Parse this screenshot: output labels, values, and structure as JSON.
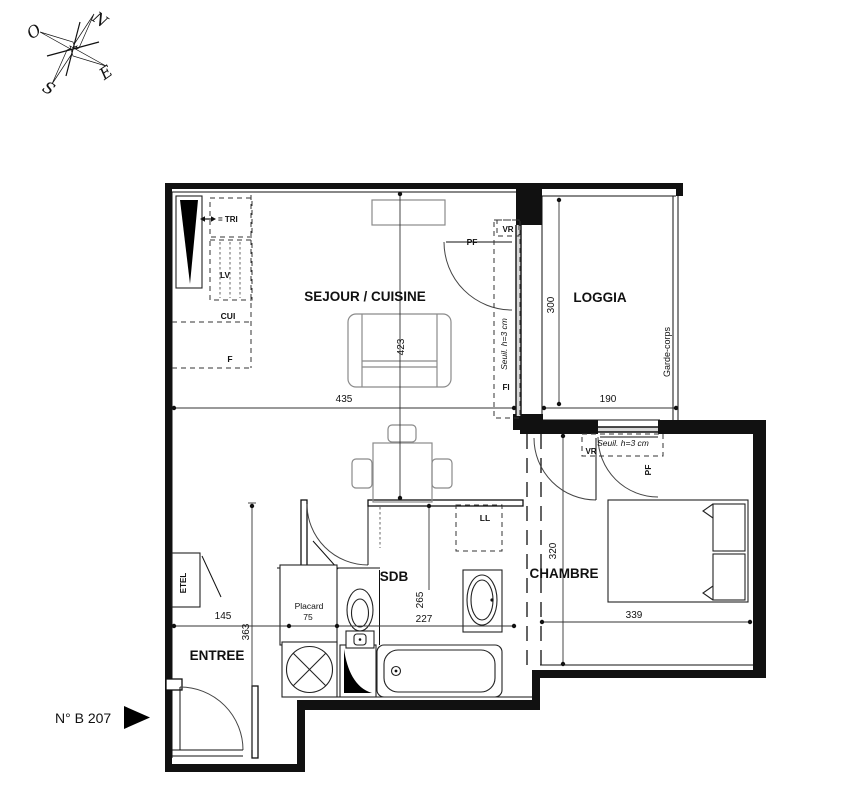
{
  "compass": {
    "north": "N",
    "west": "O",
    "south": "S",
    "east": "E"
  },
  "unit": {
    "label": "N° B 207"
  },
  "rooms": {
    "sejour": {
      "name": "SEJOUR / CUISINE",
      "width_cm": "435",
      "depth_cm": "423"
    },
    "loggia": {
      "name": "LOGGIA",
      "width_cm": "190",
      "depth_cm": "300",
      "railing": "Garde-corps"
    },
    "chambre": {
      "name": "CHAMBRE",
      "width_cm": "339",
      "depth_cm": "320"
    },
    "sdb": {
      "name": "SDB",
      "width_cm": "227",
      "depth_cm": "265"
    },
    "entree": {
      "name": "ENTREE",
      "width_cm": "145",
      "depth_cm": "363"
    }
  },
  "labels": {
    "tri": "= TRI",
    "lv": "LV",
    "cui": "CUI",
    "fridge": "F",
    "fi": "FI",
    "vr_sejour": "VR",
    "pf_sejour": "PF",
    "seuil_sejour": "Seuil. h=3 cm",
    "vr_chambre": "VR",
    "pf_chambre": "PF",
    "seuil_chambre": "Seuil. h=3 cm",
    "ll": "LL",
    "etel": "ETEL",
    "placard_name": "Placard",
    "placard_width": "75"
  },
  "colors": {
    "line": "#111111",
    "furniture": "#8a8a8a",
    "window_fill": "#d9d9d9"
  }
}
